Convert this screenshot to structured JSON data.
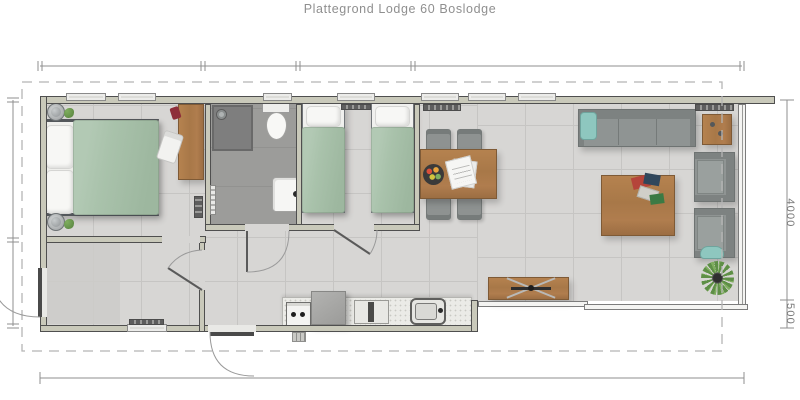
{
  "title": "Plattegrond Lodge 60 Boslodge",
  "dimension_labels": {
    "right_main": "4000",
    "right_overhang": "500"
  },
  "palette": {
    "title": "#8f8f8f",
    "wall": "#c9c9ba",
    "wall_edge": "#4f4f4f",
    "floor": "#d7d6d4",
    "tile": "#c6c5c3",
    "entry": "#cccbc9",
    "bath": "#9c9c9a",
    "shower": "#7e7e7e",
    "duvet": "#a9c2ab",
    "teal": "#8ec7bf",
    "wood": "#a87848",
    "wood_light": "#b5824f",
    "wood_dark": "#7e5a36",
    "sofa": "#8f9493",
    "sofa_dark": "#7d8281",
    "counter": "#ebebe7",
    "dim": "#8f8f8f",
    "dash": "#b5b5b5",
    "radiator": "#5e5e5e",
    "plant": "#5e8f46"
  },
  "plan": {
    "type": "floorplan",
    "rooms": [
      "master-bedroom",
      "bathroom",
      "second-bedroom",
      "entry-hall",
      "hallway",
      "kitchen",
      "dining-area",
      "living-room"
    ],
    "furniture": [
      "double-bed",
      "bedside-lamps",
      "desk",
      "desk-chair",
      "shower",
      "toilet",
      "washbasin",
      "single-bed-left",
      "single-bed-right",
      "dining-table",
      "dining-chairs",
      "fruit-bowl",
      "magazine",
      "kitchen-counter",
      "oven",
      "fridge",
      "gas-hob",
      "kitchen-sink",
      "sideboard",
      "sofa",
      "side-table",
      "armchairs",
      "coffee-table",
      "plants",
      "radiators"
    ]
  }
}
